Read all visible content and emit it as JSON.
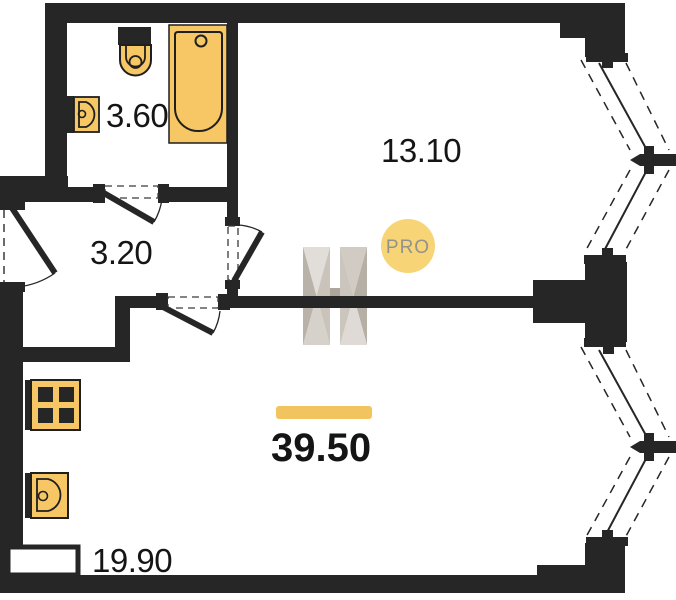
{
  "areas": {
    "bathroom": "3.60",
    "hallway": "3.20",
    "bedroom": "13.10",
    "living_room": "19.90",
    "total": "39.50"
  },
  "watermark": {
    "badge": "PRO"
  },
  "colors": {
    "wall": "#262626",
    "fixture_fill": "#f6c764",
    "fixture_stroke": "#1f1f1f",
    "accent_bar": "#f2c45f",
    "badge_circle": "#f7d26f",
    "badge_text": "#8f8d87"
  }
}
